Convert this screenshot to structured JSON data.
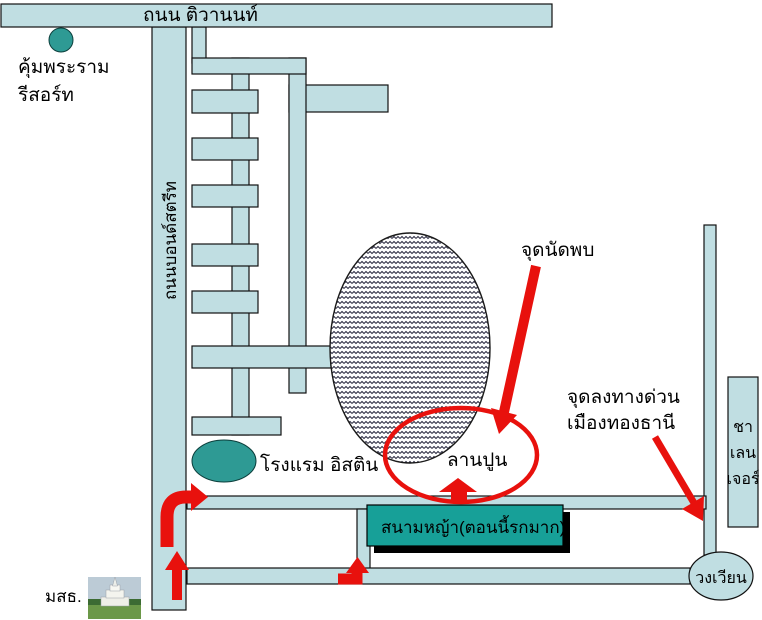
{
  "map": {
    "roads": {
      "tiwanon_label": "ถนน ติวานนท์",
      "bond_street_label": "ถนนบอนด์สตรีท"
    },
    "places": {
      "resort_line1": "คุ้มพระราม",
      "resort_line2": "รีสอร์ท",
      "hotel": "โรงแรม อิสติน",
      "concrete_yard": "ลานปูน",
      "lawn": "สนามหญ้า(ตอนนี้รกมาก)",
      "challenger_line1": "ชา",
      "challenger_line2": "เลน",
      "challenger_line3": "เจอร์",
      "roundabout": "วงเวียน",
      "university": "มสธ."
    },
    "annotations": {
      "meeting_point": "จุดนัดพบ",
      "expressway_exit_line1": "จุดลงทางด่วน",
      "expressway_exit_line2": "เมืองทองธานี"
    },
    "colors": {
      "road_fill": "#c0dee2",
      "landmark_teal": "#2e9a94",
      "lawn_teal": "#17a098",
      "route_red": "#e8110d"
    }
  }
}
